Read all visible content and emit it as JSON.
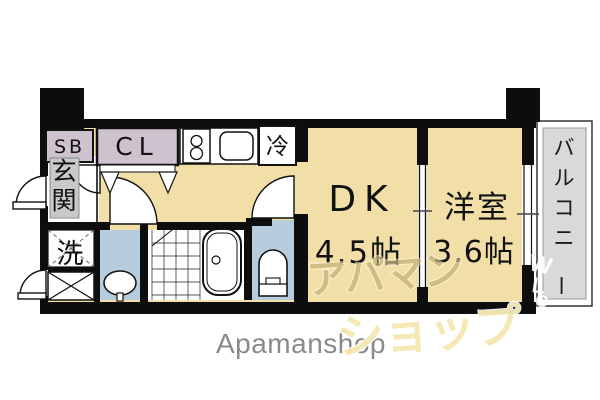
{
  "footer": {
    "brand": "Apamanshop"
  },
  "watermark": {
    "line1": "アパマン",
    "line2": "ショップ",
    "mark_w": "W",
    "mark_l": "L"
  },
  "rooms": {
    "shoe_box": "SB",
    "closet": "CL",
    "fridge": "冷",
    "entrance": "玄関",
    "laundry": "洗",
    "dk_name": "DK",
    "dk_size": "4.5帖",
    "western_name": "洋室",
    "western_size": "3.6帖",
    "balcony": "バルコニー"
  },
  "colors": {
    "floor": "#f1dfa7",
    "closet_box": "#cfc2cf",
    "entrance_bg": "#c9c9c9",
    "balcony_fill": "#d9d9d9",
    "water": "#b7cddd",
    "wall": "#0d0d0d"
  }
}
